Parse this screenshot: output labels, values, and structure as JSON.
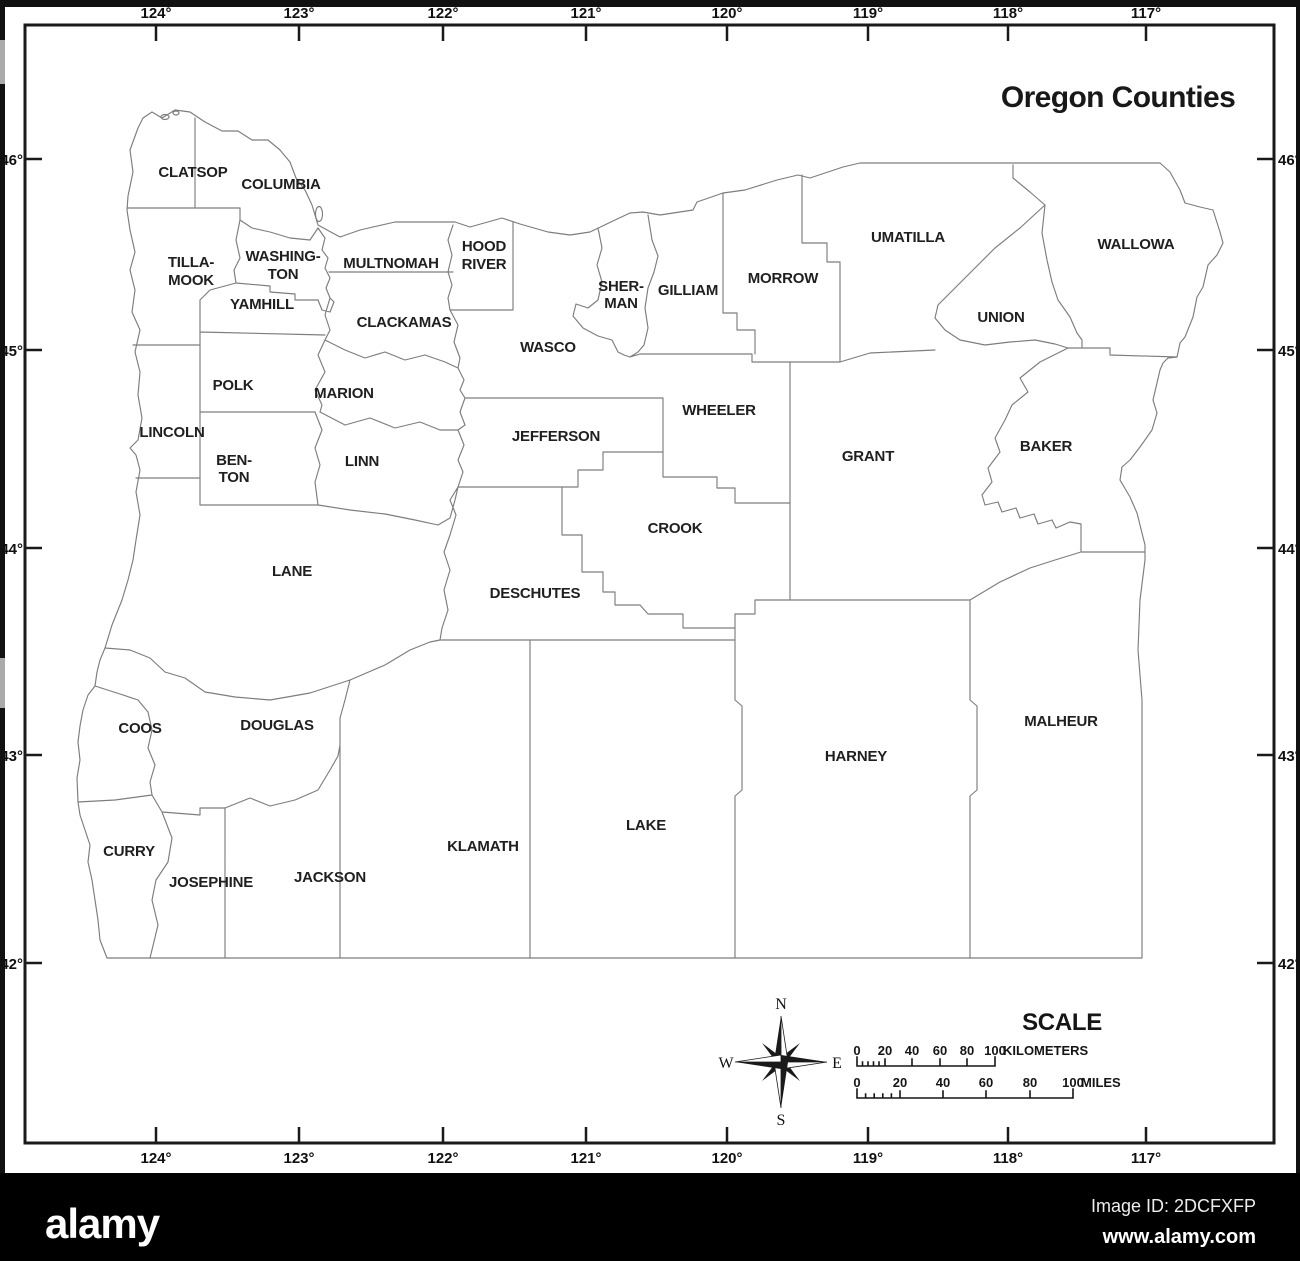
{
  "title": "Oregon Counties",
  "axes": {
    "top": [
      "124°",
      "123°",
      "122°",
      "121°",
      "120°",
      "119°",
      "118°",
      "117°"
    ],
    "bottom": [
      "124°",
      "123°",
      "122°",
      "121°",
      "120°",
      "119°",
      "118°",
      "117°"
    ],
    "left": [
      "46°",
      "45°",
      "44°",
      "43°",
      "42°"
    ],
    "right": [
      "46°",
      "45°",
      "44°",
      "43°",
      "42°"
    ]
  },
  "county_labels": [
    "CLATSOP",
    "COLUMBIA",
    "TILLA-",
    "MOOK",
    "WASHING-",
    "TON",
    "MULTNOMAH",
    "HOOD",
    "RIVER",
    "SHER-",
    "MAN",
    "GILLIAM",
    "MORROW",
    "UMATILLA",
    "WALLOWA",
    "UNION",
    "CLACKAMAS",
    "WASCO",
    "YAMHILL",
    "POLK",
    "MARION",
    "LINCOLN",
    "BEN-",
    "TON",
    "LINN",
    "JEFFERSON",
    "WHEELER",
    "GRANT",
    "BAKER",
    "CROOK",
    "DESCHUTES",
    "LANE",
    "COOS",
    "DOUGLAS",
    "CURRY",
    "JOSEPHINE",
    "JACKSON",
    "KLAMATH",
    "LAKE",
    "HARNEY",
    "MALHEUR"
  ],
  "compass": {
    "north": "N",
    "east": "E",
    "south": "S",
    "west": "W"
  },
  "scale": {
    "heading": "SCALE",
    "km_ticks": [
      "0",
      "20",
      "40",
      "60",
      "80",
      "100"
    ],
    "km_unit": "KILOMETERS",
    "mile_ticks": [
      "0",
      "20",
      "40",
      "60",
      "80",
      "100"
    ],
    "mile_unit": "MILES"
  },
  "footer": {
    "brand": "alamy",
    "image_id": "Image ID: 2DCFXFP",
    "url": "www.alamy.com"
  },
  "colors": {
    "county_line": "#7d7d7d",
    "frame": "#1a1a1a",
    "footer_bg": "#000000",
    "text": "#1c1c1c"
  }
}
